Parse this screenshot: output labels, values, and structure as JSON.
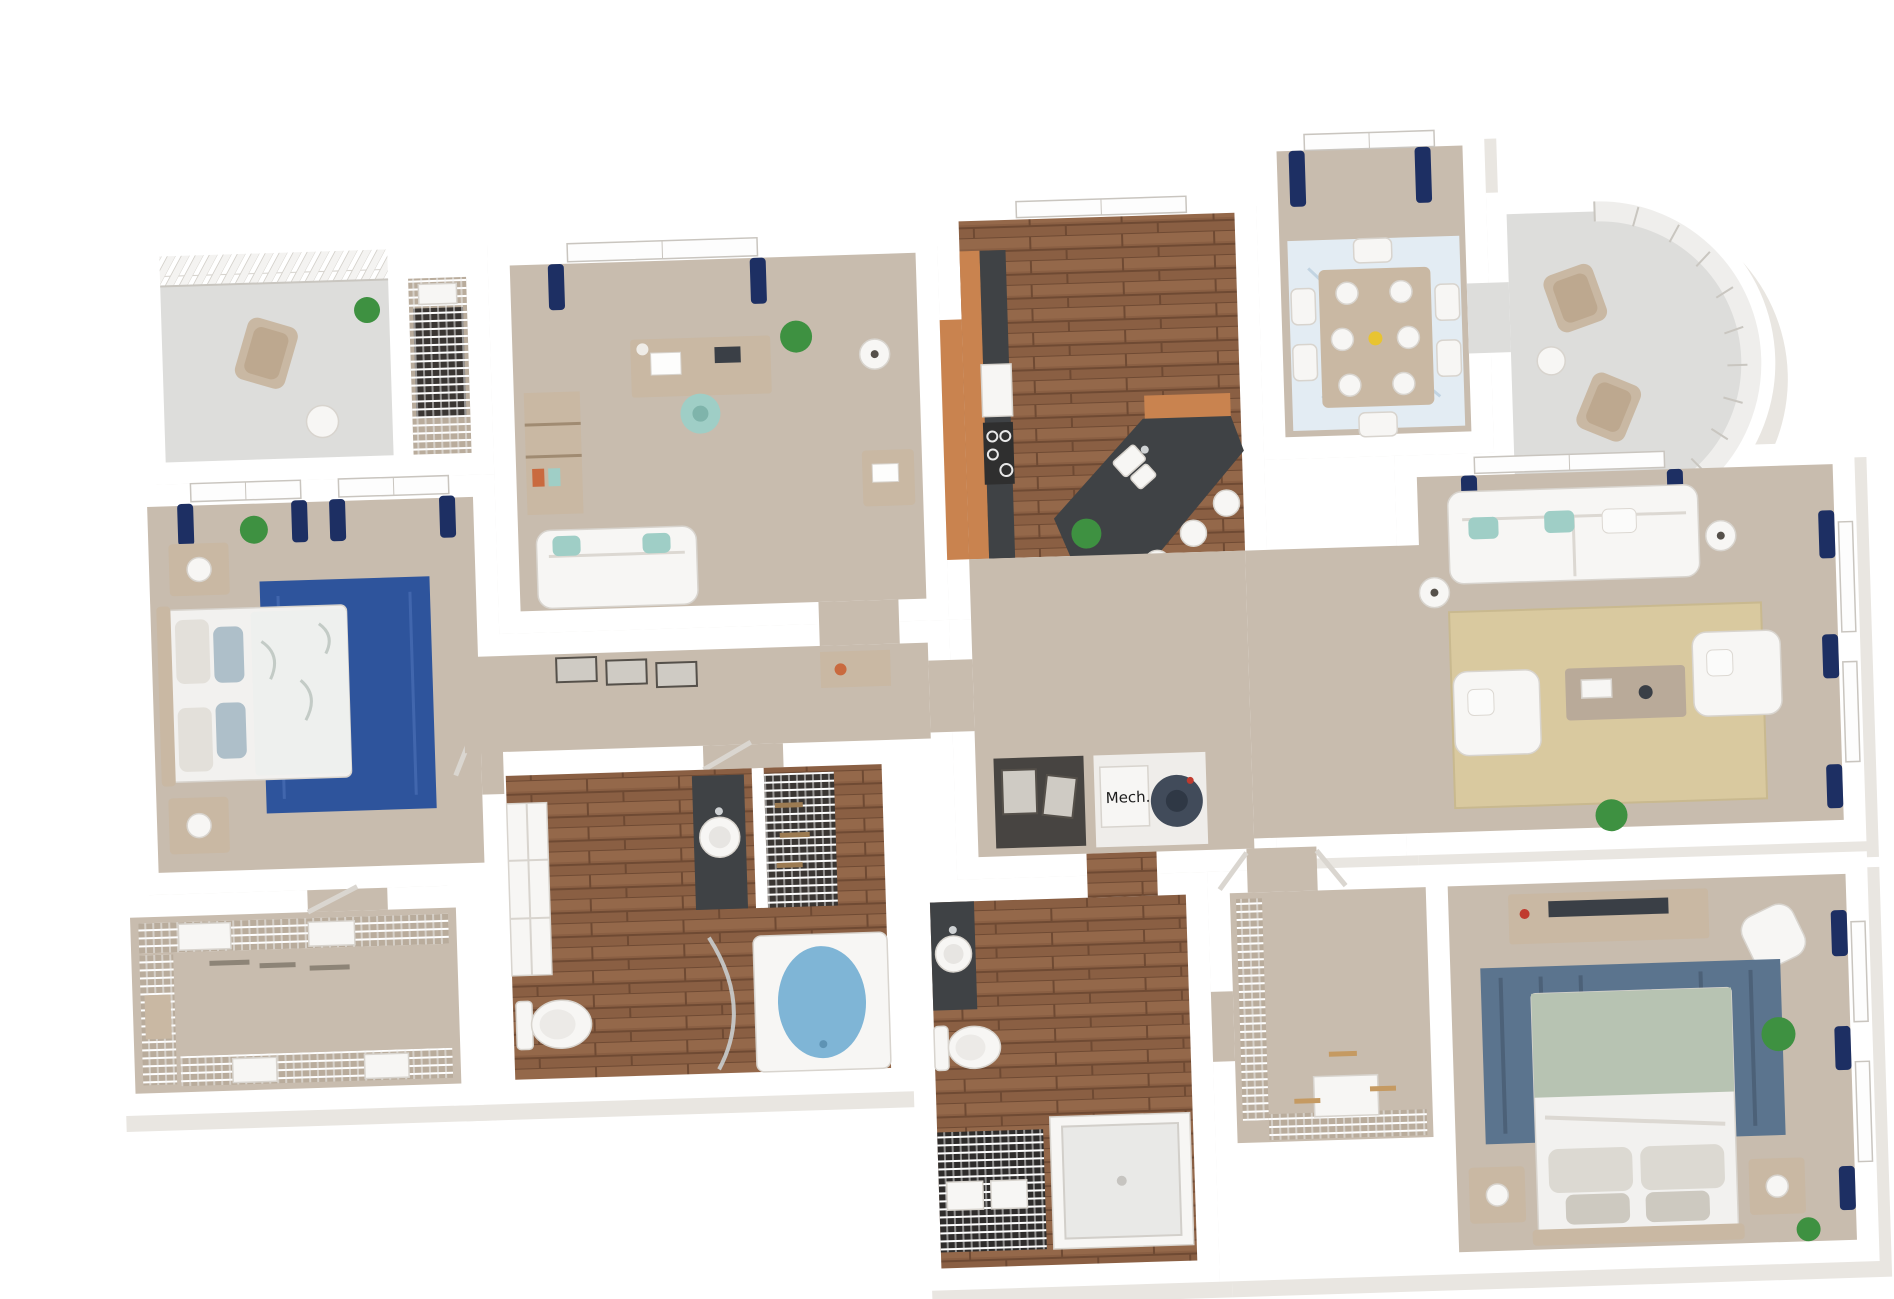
{
  "labels": {
    "mech": "Mech."
  },
  "palette": {
    "carpet": "#c8bcae",
    "carpet_dark": "#b9ac9c",
    "wood": "#8a5f43",
    "cabinet_wood": "#c9834f",
    "granite": "#3f4245",
    "balcony_floor": "#dddddb",
    "curtain_navy": "#1d2f63",
    "rug_blue": "#2e549c",
    "rug_master": "#5b748e",
    "rug_dining": "#e3ecf3",
    "rug_living": "#d9c99f",
    "tub_blue": "#7fb5d6",
    "sage": "#b7c3b2",
    "accent_teal": "#9fcec6",
    "plant_green": "#3e9141",
    "shelf_dark": "#2e2c2b"
  }
}
